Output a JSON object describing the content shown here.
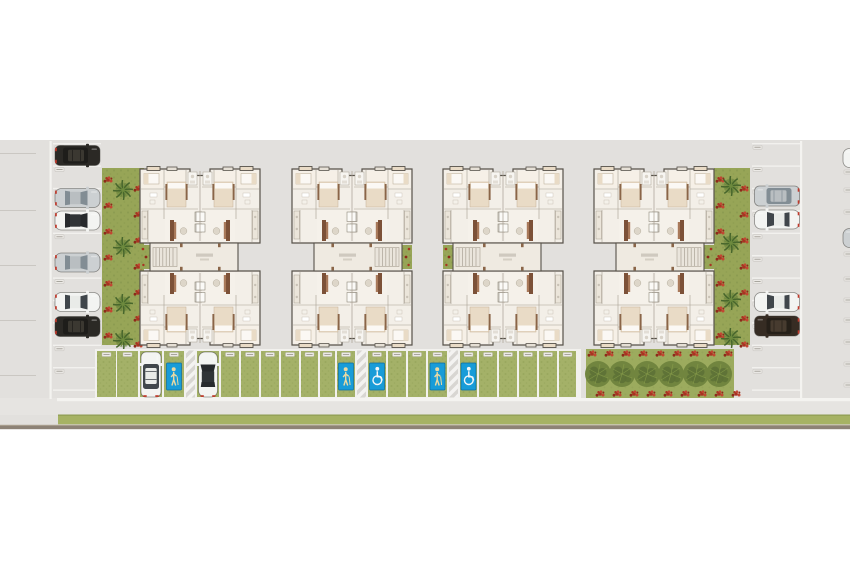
{
  "meta": {
    "title": "Condominium site plan - top view implantation",
    "description": "Architectural rendering: 4 apartment blocks, side parking columns, grass-paver parking row, palm garden strips, tree grove, perimeter streets"
  },
  "summary": {
    "apartment_blocks": 4,
    "units_per_block": 4,
    "left_column_spaces": 11,
    "right_column_spaces": 11,
    "bottom_row_spaces": 25,
    "senior_sign_spaces": 3,
    "accessible_sign_spaces": 2,
    "parked_cars_full": 12,
    "parked_cars_partial_edge": 6
  },
  "palette": {
    "canvas": "#ffffff",
    "ground": "#e2e0dd",
    "road_lower": "#e6e4e1",
    "white_line": "#f4f3f0",
    "divider": "#f2f1ee",
    "stub_line": "#cac7c2",
    "verge_green": "#a6b264",
    "verge_green_dark": "#8e9c52",
    "border_dark": "#8d8276",
    "border_light": "#a79c8c",
    "strip_green": "#97a557",
    "strip_green_dark": "#86954c",
    "palm": "#6d8a3e",
    "palm_dark": "#47662c",
    "flower_red": "#a83322",
    "flower_red_dark": "#8d2a1a",
    "flower_red_light": "#c24632",
    "grove_green": "#9cab5e",
    "tree_fill": "#71853f",
    "tree_blob": "#5c7036",
    "tree_light": "#8ba04c",
    "grass_cell": "#a4b168",
    "grass_cell_dark": "#8fa055",
    "sign_blue": "#189cd8",
    "sign_blue_dark": "#0c6ea0",
    "sign_icon_tan": "#ead9a2",
    "sign_icon_white": "#f2f6f8",
    "hatch_gray": "#d8d6d2",
    "hatch_white": "#f4f3f1",
    "chip_fill": "#eceae6",
    "chip_stroke": "#b7b4ae",
    "chip_line": "#98948b",
    "wall": "#57524a",
    "floor": "#f3efe8",
    "corridor": "#efeae1",
    "inner_line": "#a79f92",
    "bed_tan": "#e9dbc6",
    "pillow_white": "#fbf8f4",
    "brown": "#8a6548",
    "sofa_brown": "#7c5138",
    "sofa_light": "#a8795a",
    "table": "#ddd6c9",
    "stair_fill": "#eae5dc",
    "stair_line": "#a9a194",
    "label_bar": "#c9c3b8",
    "shaft_fill": "#fbfaf7",
    "room_tint": "#f6f0e7",
    "living_tint": "#f5f1ea"
  },
  "cars_palette": {
    "white": {
      "body": "#f3f4f2",
      "roof": "#e9ebe8",
      "glass": "#40464b"
    },
    "silver": {
      "body": "#ccd0d2",
      "roof": "#b9bec1",
      "glass": "#828d94"
    },
    "black": {
      "body": "#2b2925",
      "roof": "#3b3831",
      "glass": "#1e1d1a"
    },
    "brown": {
      "body": "#362c23",
      "roof": "#473b2f",
      "glass": "#262019"
    },
    "white_black": {
      "body": "#f3f4f2",
      "roof": "#303437",
      "glass": "#272a2d"
    }
  },
  "site": {
    "ground_y": 140,
    "ground_h": 289,
    "road_lower_y": 398,
    "road_lower_h": 17,
    "curb_y": 398,
    "curb_x": 57,
    "curb_w": 793,
    "verge_x": 58,
    "verge_y": 414.5,
    "verge_w": 792,
    "verge_h": 9.8,
    "border_y": 425.6,
    "left_curb_x": 49.5,
    "right_curb_x": 800
  },
  "blocks": {
    "y": 169,
    "list": [
      {
        "id": "block-1",
        "x": 140,
        "mirrored": false
      },
      {
        "id": "block-2",
        "x": 412,
        "mirrored": true
      },
      {
        "id": "block-3",
        "x": 443,
        "mirrored": false
      },
      {
        "id": "block-4",
        "x": 714,
        "mirrored": true
      }
    ]
  },
  "left_column": {
    "x": 53,
    "width": 48,
    "first_y": 143,
    "pitch": 22.4,
    "lines": 12,
    "cars": [
      {
        "y": 145,
        "kind": "suv",
        "color": "black"
      },
      {
        "y": 188,
        "kind": "sedan",
        "color": "silver"
      },
      {
        "y": 210.5,
        "kind": "sedan",
        "color": "white_black"
      },
      {
        "y": 252.5,
        "kind": "sedan",
        "color": "silver"
      },
      {
        "y": 292,
        "kind": "sedan",
        "color": "white"
      },
      {
        "y": 316,
        "kind": "suv",
        "color": "black"
      }
    ]
  },
  "right_column": {
    "x": 752,
    "width": 48,
    "first_y": 143,
    "pitch": 22.4,
    "lines": 12,
    "cars": [
      {
        "y": 185.5,
        "kind": "suv",
        "color": "silver"
      },
      {
        "y": 209.5,
        "kind": "sedan",
        "color": "white"
      },
      {
        "y": 292,
        "kind": "sedan",
        "color": "white"
      },
      {
        "y": 315.5,
        "kind": "suv",
        "color": "brown"
      }
    ]
  },
  "left_street": {
    "line_ys": [
      153,
      210,
      265,
      320,
      375
    ],
    "stub_cars": [
      {
        "y": 139,
        "kind": "sedan",
        "color": "white"
      },
      {
        "y": 229,
        "kind": "suv",
        "color": "black"
      },
      {
        "y": 286,
        "kind": "sedan",
        "color": "white"
      },
      {
        "y": 334,
        "kind": "sedan",
        "color": "white"
      }
    ]
  },
  "right_street": {
    "chip_ys": [
      170,
      188,
      210,
      232,
      252,
      277,
      298,
      318,
      340,
      362,
      383
    ],
    "stub_cars": [
      {
        "y": 148,
        "kind": "sedan",
        "color": "white"
      },
      {
        "y": 228,
        "kind": "sedan",
        "color": "silver"
      }
    ]
  },
  "green_strips": {
    "y": 168,
    "h": 177,
    "list": [
      {
        "x": 102,
        "w": 42,
        "palm_x": 123,
        "palm_ys": [
          190,
          247,
          304,
          340
        ],
        "flower_cols": [
          108,
          138
        ]
      },
      {
        "x": 714,
        "w": 36,
        "palm_x": 731,
        "palm_ys": [
          186,
          243,
          300,
          338
        ],
        "flower_cols": [
          720,
          744
        ]
      }
    ]
  },
  "bottom_row": {
    "band_x": 95,
    "band_y": 349,
    "band_w": 486,
    "band_h": 49.5,
    "cells": [
      {
        "x": 97,
        "w": 19,
        "t": "g"
      },
      {
        "x": 117,
        "w": 21,
        "t": "g"
      },
      {
        "x": 140,
        "w": 22,
        "t": "car"
      },
      {
        "x": 164,
        "w": 20,
        "t": "senior"
      },
      {
        "x": 186,
        "w": 9,
        "t": "hatch"
      },
      {
        "x": 197,
        "w": 22,
        "t": "car"
      },
      {
        "x": 221,
        "w": 18,
        "t": "g"
      },
      {
        "x": 241,
        "w": 18,
        "t": "g"
      },
      {
        "x": 261,
        "w": 18,
        "t": "g"
      },
      {
        "x": 281,
        "w": 18,
        "t": "g"
      },
      {
        "x": 301,
        "w": 17,
        "t": "g"
      },
      {
        "x": 320,
        "w": 15,
        "t": "g"
      },
      {
        "x": 337,
        "w": 18,
        "t": "senior"
      },
      {
        "x": 357,
        "w": 9,
        "t": "hatch"
      },
      {
        "x": 368,
        "w": 18,
        "t": "accessible"
      },
      {
        "x": 388,
        "w": 18,
        "t": "g"
      },
      {
        "x": 408,
        "w": 18,
        "t": "g"
      },
      {
        "x": 428,
        "w": 19,
        "t": "senior"
      },
      {
        "x": 449,
        "w": 9,
        "t": "hatch"
      },
      {
        "x": 460,
        "w": 17,
        "t": "accessible"
      },
      {
        "x": 479,
        "w": 18,
        "t": "g"
      },
      {
        "x": 499,
        "w": 18,
        "t": "g"
      },
      {
        "x": 519,
        "w": 18,
        "t": "g"
      },
      {
        "x": 539,
        "w": 18,
        "t": "g"
      },
      {
        "x": 559,
        "w": 17,
        "t": "g"
      }
    ],
    "cars": [
      {
        "cx": 151,
        "kind": "suv",
        "color": "white"
      },
      {
        "cx": 208,
        "kind": "sedan",
        "color": "white_black"
      }
    ]
  },
  "grove": {
    "x": 586,
    "y": 349,
    "w": 148,
    "h": 50,
    "tree_xs": [
      598,
      622,
      647,
      671,
      696,
      719
    ],
    "tree_y": 374,
    "flower_top_y": 354,
    "flower_bottom_y": 394,
    "flower_step": 17
  },
  "icons": {
    "senior_sign": "standing-person-icon",
    "accessible_sign": "wheelchair-icon",
    "palm": "palm-tree-icon",
    "flower": "red-flower-cluster",
    "tree": "round-tree-canopy"
  }
}
